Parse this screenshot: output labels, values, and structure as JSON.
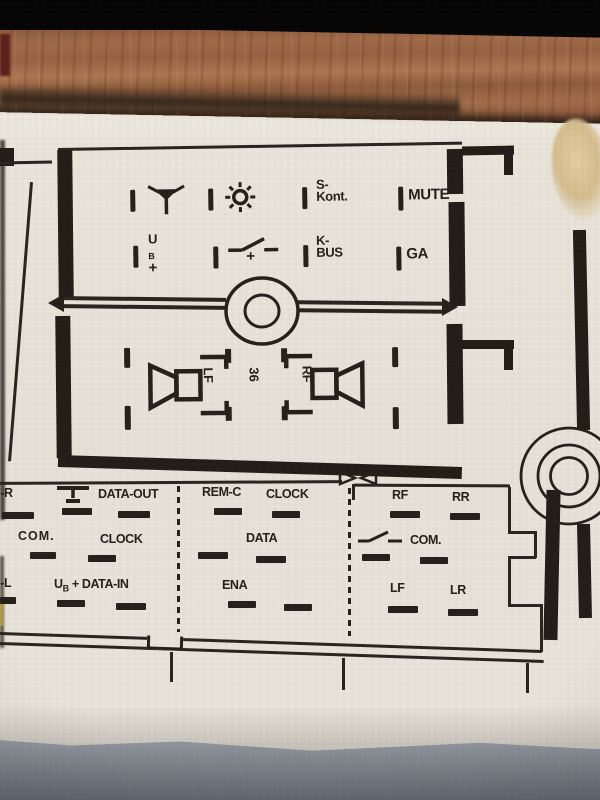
{
  "colors": {
    "ink": "#27221c",
    "paper": "#e8e4da",
    "wood": "#9a6847",
    "fabric": "#a7afb6",
    "stain": "#dbc79c",
    "top_bar": "#060606"
  },
  "radio_pinout": {
    "top_connector": {
      "row1": {
        "pin1_icon": "antenna",
        "pin2_icon": "illumination",
        "pin3_label_line1": "S-",
        "pin3_label_line2": "Kont.",
        "pin4_label": "MUTE"
      },
      "row2": {
        "pin1_label_main": "U",
        "pin1_label_sub": "B",
        "pin1_label_plus": "+",
        "pin2_icon": "switched-plus",
        "pin2_label_plus": "+",
        "pin3_label_line1": "K-",
        "pin3_label_line2": "BUS",
        "pin4_label": "GA"
      }
    },
    "speaker_section": {
      "left_speaker_label": "LF",
      "right_speaker_label": "RF",
      "center_rotated_label": "36",
      "center_icon": "screw"
    },
    "bottom_connector": {
      "left_block": {
        "row1": {
          "label1": "F-R",
          "icon": "ground",
          "label2": "DATA-OUT"
        },
        "row2": {
          "label1": "COM.",
          "label2": "CLOCK"
        },
        "row3": {
          "label1": "F-L",
          "label2_main": "U",
          "label2_sub": "B",
          "label2_plus": "+",
          "label3": "DATA-IN"
        }
      },
      "middle_block": {
        "row1": {
          "label1": "REM-C",
          "label2": "CLOCK"
        },
        "row2": {
          "label1": "DATA"
        },
        "row3": {
          "label1": "ENA"
        }
      },
      "right_block": {
        "row1": {
          "label1": "RF",
          "label2": "RR"
        },
        "row2": {
          "icon": "switched-contact",
          "label1": "COM."
        },
        "row3": {
          "label1": "LF",
          "label2": "LR"
        }
      }
    }
  }
}
